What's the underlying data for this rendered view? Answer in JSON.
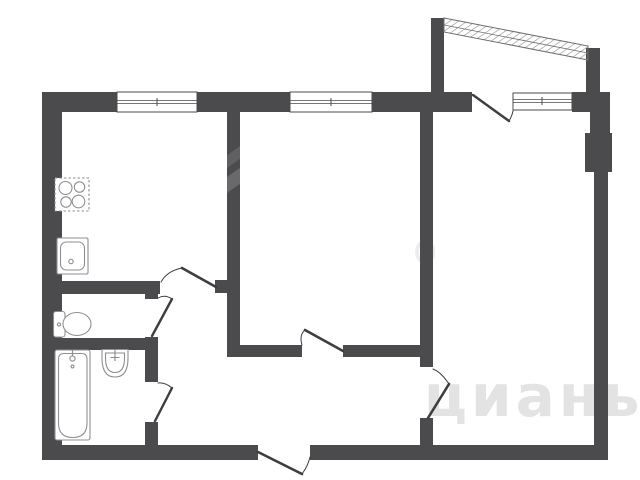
{
  "colors": {
    "background": "#ffffff",
    "wall": "#4b4b4d",
    "door_line": "#3e3e40",
    "fixture_line": "#8f8f8f",
    "glazing_line": "#6f6f71",
    "watermark": "#e3e3e3",
    "watermark_faint": "#ececec"
  },
  "watermark": {
    "text": "циань",
    "fragment": "о"
  },
  "plan": {
    "type": "apartment-floor-plan",
    "style": "monochrome architectural line drawing",
    "rooms": [
      "kitchen",
      "wc",
      "bathroom",
      "hallway",
      "room-1",
      "room-2",
      "balcony"
    ],
    "fixtures": [
      "stove",
      "kitchen-sink",
      "toilet",
      "bathtub",
      "washbasin"
    ],
    "window_count": 3,
    "door_count": 7
  }
}
